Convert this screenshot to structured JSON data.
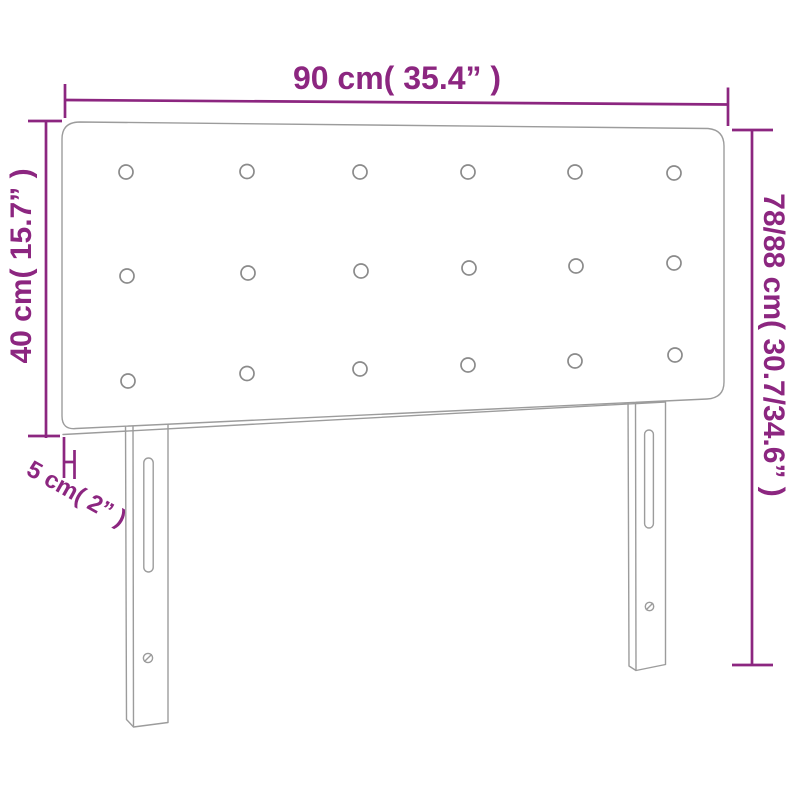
{
  "page": {
    "background": "#ffffff"
  },
  "colors": {
    "dimension_purple": "#8C2680",
    "outline_gray": "#9C9C9C",
    "button_gray": "#8A8A8A"
  },
  "dimensions": {
    "width": "90 cm( 35.4” )",
    "panel_height": "40 cm( 15.7” )",
    "total_height": "78/88 cm( 30.7/34.6” )",
    "depth": "5 cm( 2” )"
  },
  "product": {
    "type": "upholstered headboard with two legs",
    "tufting_buttons": {
      "rows": 3,
      "columns": 6,
      "total": 18
    },
    "legs": 2,
    "slots_per_leg": 1,
    "screw_holes_per_leg": 1
  }
}
